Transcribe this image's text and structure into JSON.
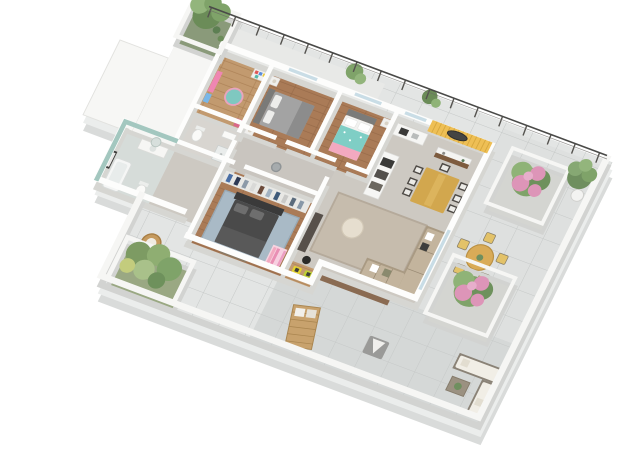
{
  "title": "3D isometric floor-plan rendering of an apartment with wrap-around terrace",
  "style_note": "white paper-model walls, top-down dimetric view, no text labels visible",
  "palette": {
    "background": "#ffffff",
    "slab_edge": "#d9dbda",
    "terrace_tile": "#e3e5e4",
    "terrace_tile_inner": "#d5d8d7",
    "grout": "#c6c9c8",
    "interior_floor": "#cdc9c2",
    "hall_floor": "#c9c5bf",
    "wood": "#aa7b57",
    "wood_light": "#c29a6f",
    "wall_white": "#fdfdfc",
    "bathroom_teal": "#a3c7bf",
    "accent_yellow": "#eebf55",
    "bed_teal": "#7fcec5",
    "pink_accent": "#f2a9c0",
    "master_bed": "#4a4a4a",
    "master_rug": "#a9bac6",
    "living_rug": "#c6bcad",
    "sofa": "#c3b49d",
    "pouf": "#e6decf",
    "dining_table": "#d2a74e",
    "outdoor_table": "#d9ab57",
    "outdoor_chair_yellow": "#e3c268",
    "flower_pink": "#dd95b8",
    "foliage": "#7fa369",
    "toy_car_yellow": "#e5d430",
    "deck_brown": "#8a6b52",
    "railing": "#4a4a48",
    "wicker": "#c59a5e",
    "armchair_gray": "#9a9a98",
    "gravel": "#d4d5d1",
    "glass": "#c9dde6"
  },
  "rooms": [
    {
      "id": "children-room",
      "name": "Children's room",
      "floor": "light wood",
      "items": [
        "pink unicorn wall poster",
        "toy shelf with colored boxes",
        "round teal rug",
        "toy box"
      ]
    },
    {
      "id": "wc",
      "name": "Guest WC",
      "floor": "grey tile",
      "items": [
        "toilet",
        "washbasin",
        "shower tray"
      ]
    },
    {
      "id": "bedroom-1",
      "name": "Bedroom 1",
      "floor": "wood",
      "items": [
        "grey double bed",
        "two nightstands with lamps",
        "glass balcony door"
      ]
    },
    {
      "id": "bedroom-2",
      "name": "Bedroom 2",
      "floor": "wood",
      "items": [
        "double bed with teal duvet",
        "pink throw blanket",
        "white pillows",
        "nightstand",
        "window"
      ]
    },
    {
      "id": "kitchen",
      "name": "Kitchen",
      "floor": "grey",
      "items": [
        "white island counter with dark cooktop and oven fronts",
        "wall counter with hob and sink"
      ]
    },
    {
      "id": "dining-area",
      "name": "Dining area",
      "floor": "grey",
      "items": [
        "wooden dining table",
        "seven dark chairs with white seats",
        "yellow slatted accent wall",
        "dark oval mirror",
        "white sideboard console"
      ]
    },
    {
      "id": "living-room",
      "name": "Living room",
      "floor": "grey",
      "items": [
        "L-shaped beige sectional sofa with pillows",
        "round cream pouf",
        "beige area rug",
        "dark TV cabinet",
        "black drum stool"
      ]
    },
    {
      "id": "hallway",
      "name": "Hallway",
      "floor": "grey",
      "items": [
        "round grey stool"
      ]
    },
    {
      "id": "master-bedroom",
      "name": "Master bedroom",
      "floor": "wood",
      "items": [
        "dark grey double bed",
        "open wardrobe with hanging clothes",
        "blue-grey rug",
        "bench"
      ]
    },
    {
      "id": "play-corner",
      "name": "Play corner",
      "floor": "light wood",
      "items": [
        "two yellow toy cars",
        "pink children's clothes rack"
      ]
    },
    {
      "id": "bathroom",
      "name": "Bathroom",
      "wall_color_name": "teal",
      "items": [
        "bathtub",
        "white vanity with round mirror",
        "toilet",
        "black and white framed picture"
      ]
    },
    {
      "id": "entry",
      "name": "Entry",
      "items": [
        "front door opening to terrace"
      ]
    }
  ],
  "outdoor": {
    "balcony_north": {
      "items": [
        "black metal railing with posts",
        "white planter box with tree",
        "two small potted plants",
        "green bushes"
      ]
    },
    "terrace": {
      "floor": "grey tile paving",
      "items": [
        "flower bed with pink shrub (north-east)",
        "flower bed with pink shrub (east)",
        "potted tree in white pot (corner)",
        "round wooden table with five yellow outdoor chairs",
        "white outdoor lounge sofa (L-shaped)",
        "wicker coffee table with small plant",
        "wooden sun lounger with white cushions",
        "grey armchair with white throw",
        "white planter box with green shrubs (south-west)",
        "round wicker basket chair",
        "wicker basket with blue cushions",
        "white parapet walls"
      ]
    }
  }
}
